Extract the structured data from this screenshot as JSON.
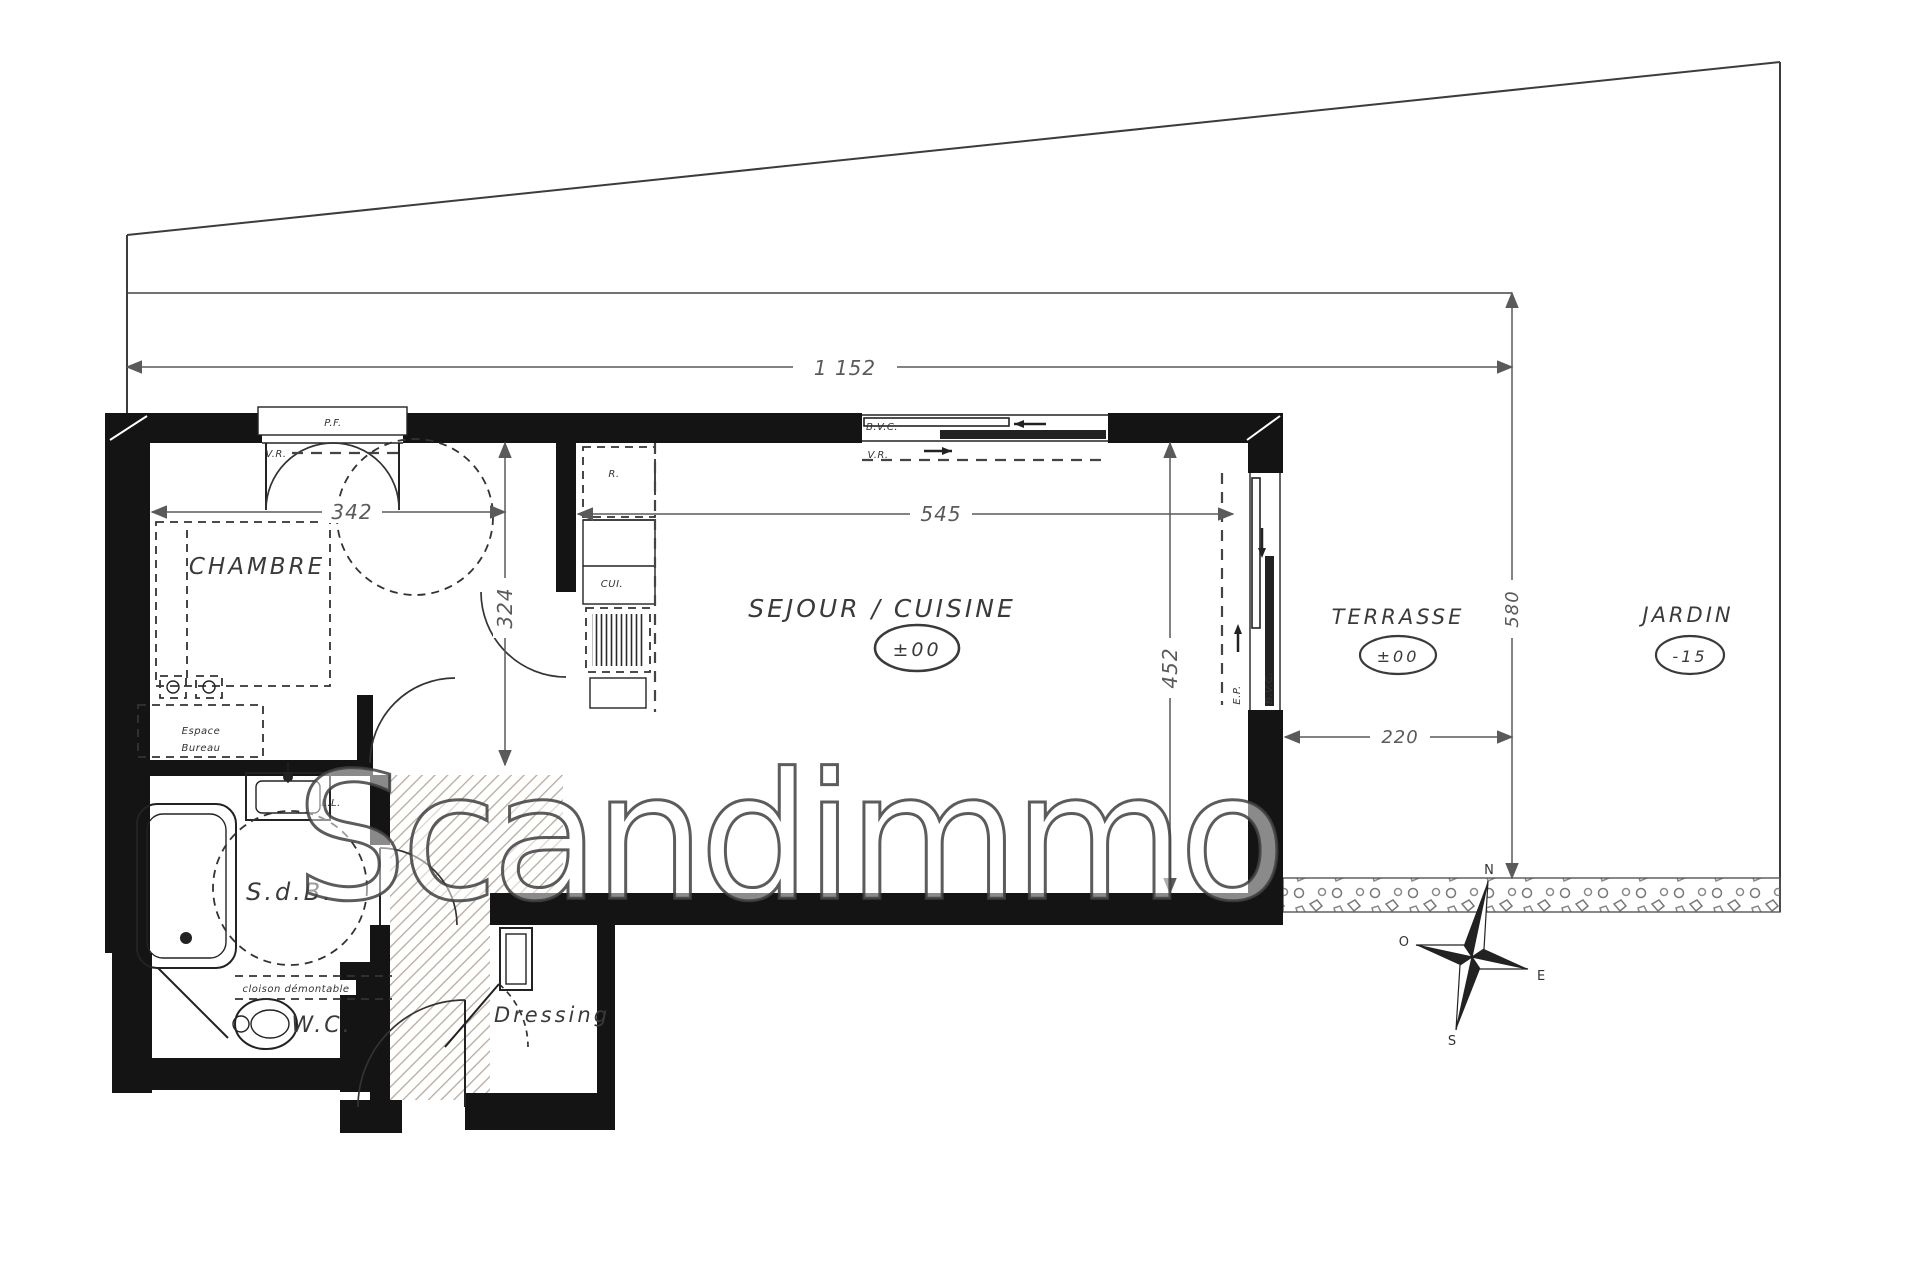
{
  "watermark": "Scandimmo",
  "dimensions": {
    "total_width": "1 152",
    "chambre_width": "342",
    "chambre_depth": "324",
    "sejour_width": "545",
    "sejour_depth": "452",
    "terrasse_width": "220",
    "garden_depth": "580"
  },
  "rooms": {
    "chambre": {
      "label": "CHAMBRE"
    },
    "sejour": {
      "label": "SEJOUR / CUISINE",
      "level": "±00"
    },
    "terrasse": {
      "label": "TERRASSE",
      "level": "±00"
    },
    "jardin": {
      "label": "JARDIN",
      "level": "-15"
    },
    "sdb": {
      "label": "S.d.B."
    },
    "wc": {
      "label": "W.C."
    },
    "dressing": {
      "label": "Dressing"
    },
    "bureau": {
      "line1": "Espace",
      "line2": "Bureau"
    }
  },
  "annotations": {
    "pf": "P.F.",
    "vr_chambre": "V.R.",
    "vr_sejour": "V.R.",
    "bvc_top": "B.V.C.",
    "bvc_right": "B.V.C.",
    "ep": "E.P.",
    "rangement": "R.",
    "cuisine_abbr": "CUI.",
    "lave_linge": "L.L.",
    "cloison": "cloison démontable"
  },
  "compass": {
    "north": "N",
    "south": "S",
    "east": "E",
    "west": "O"
  },
  "colors": {
    "wall": "#141414",
    "dim": "#5a5a5a",
    "hatch": "#b9aa9c",
    "watermark_stroke": "#404040"
  }
}
